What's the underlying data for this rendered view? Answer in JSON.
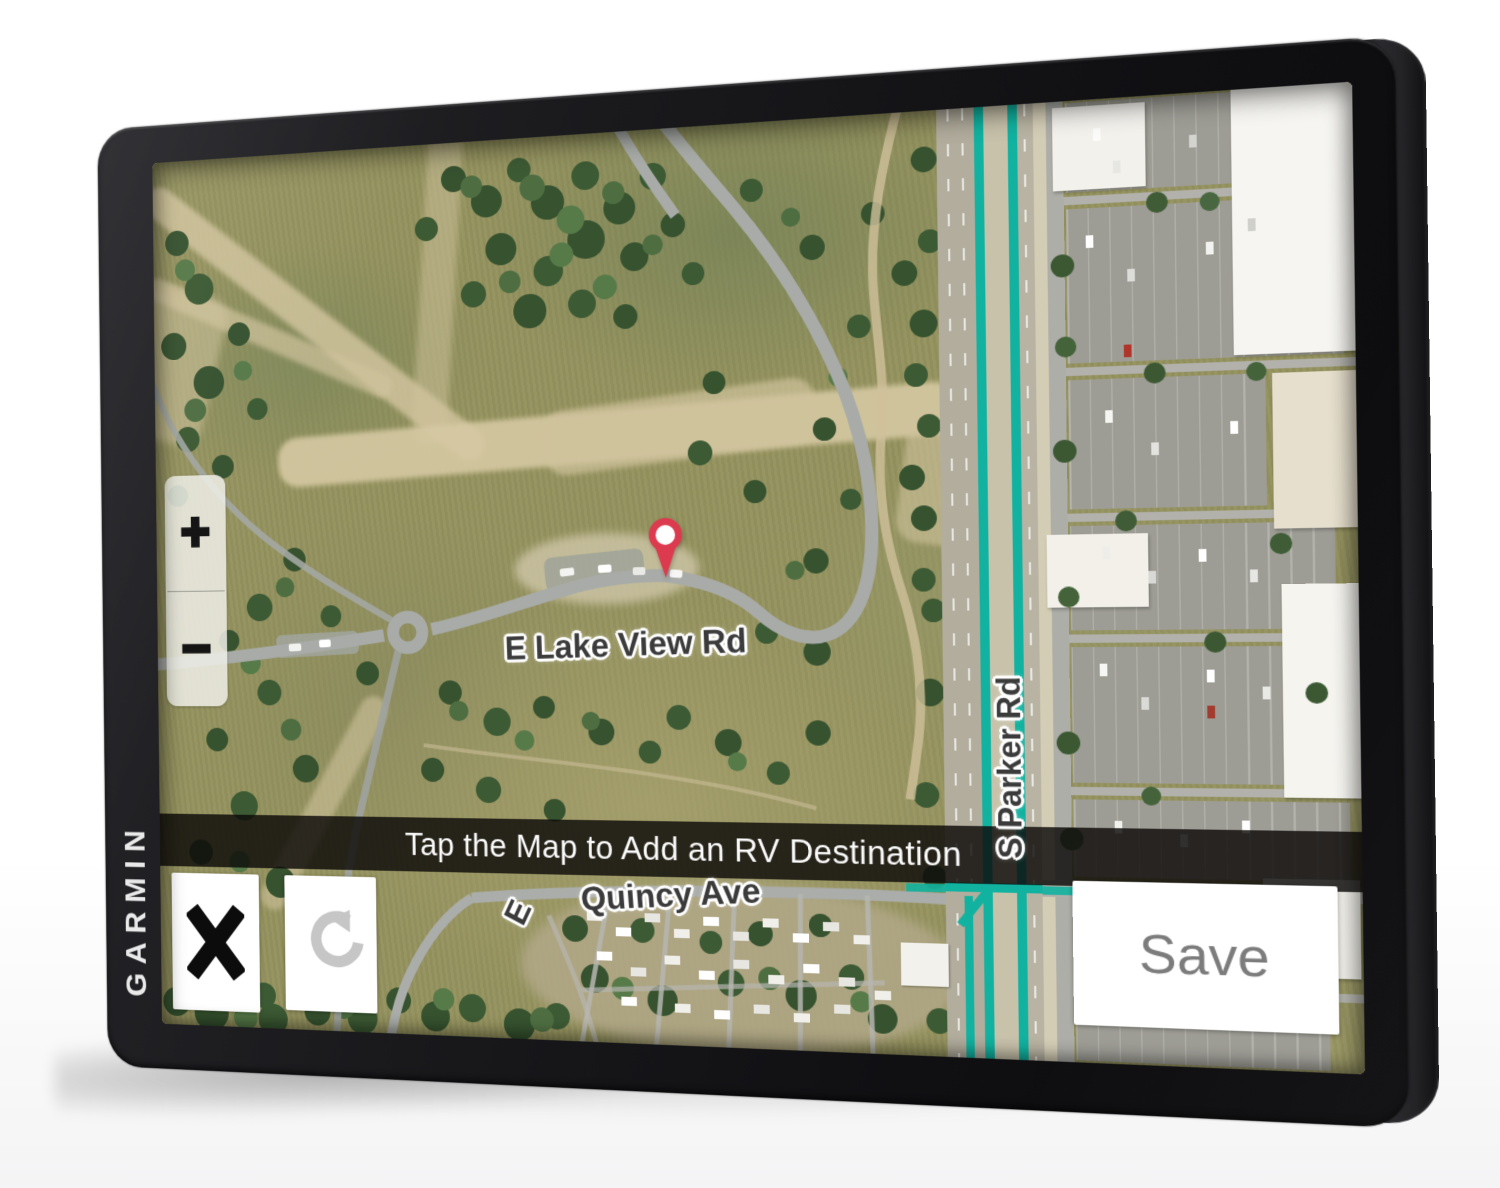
{
  "device": {
    "brand": "GARMIN",
    "type": "RV GPS navigator product photo"
  },
  "screen": {
    "banner": {
      "text": "Tap the Map to Add an RV Destination"
    },
    "map": {
      "view": "satellite",
      "road_labels": {
        "main": "E Lake View Rd",
        "vertical": "S Parker Rd",
        "bottom_prefix": "E",
        "bottom": "Quincy Ave"
      },
      "colors": {
        "route_highlight": "#12b2a0",
        "pin": "#dc3a4e",
        "field": "#95935f",
        "dirt": "#d0c39d",
        "asphalt": "#a8aba7"
      },
      "icons": {
        "pin": "map-pin-icon"
      }
    },
    "zoom": {
      "in": "+",
      "out": "−"
    },
    "buttons": {
      "cancel_icon": "x-icon",
      "undo_icon": "undo-icon",
      "save": "Save"
    }
  }
}
